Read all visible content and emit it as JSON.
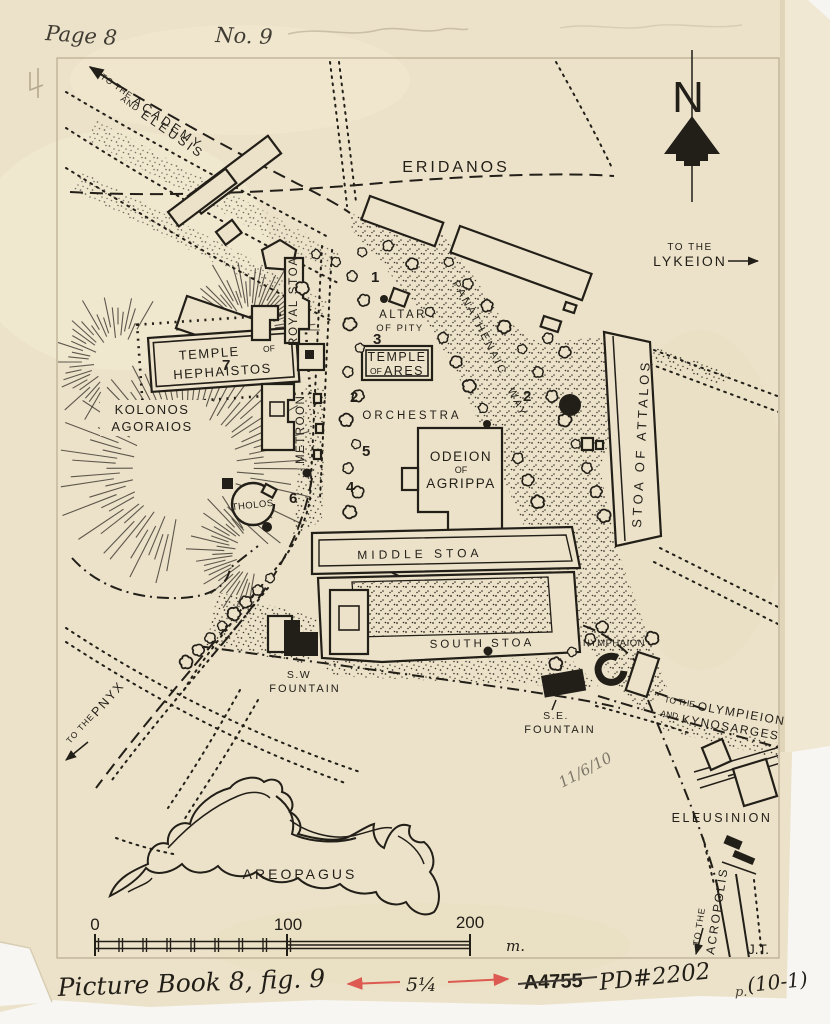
{
  "colors": {
    "ink": "#221e18",
    "paper": "#ece2c9",
    "pencil": "#998b72",
    "red": "#dd5a52",
    "blue": "#5560aa",
    "faded_red": "#e0767d"
  },
  "handwriting": {
    "page": "Page 8",
    "no9": "No. 9",
    "caption": "Picture Book 8, fig. 9",
    "measure": "5¼",
    "catalog": "A4755",
    "pd": "PD#2202",
    "p_small": "p.",
    "paren": "(10-1)",
    "date_faint": "11/6/10",
    "initials": "J.T."
  },
  "compass": {
    "n": "N"
  },
  "scalebar": {
    "t0": "0",
    "t100": "100",
    "t200": "200",
    "unit": "m."
  },
  "directions": {
    "academy_small": "TO THE",
    "academy": "ACADEMY",
    "and_small": "AND",
    "eleusis": "ELEUSIS",
    "lykeion_small": "TO THE",
    "lykeion": "LYKEION",
    "pnyx_small": "TO THE",
    "pnyx": "PNYX",
    "oly_small": "TO THE",
    "olympieion": "OLYMPIEION",
    "and2_small": "AND",
    "kynosarges": "KYNOSARGES",
    "acr_small": "TO THE",
    "acropolis": "ACROPOLIS"
  },
  "features": {
    "eridanos": "ERIDANOS",
    "kolonos1": "KOLONOS",
    "kolonos2": "AGORAIOS",
    "heph1": "TEMPLE",
    "heph_of": "OF",
    "heph2": "HEPHAISTOS",
    "royal_stoa": "ROYAL STOA",
    "metroon": "METROON",
    "tholos": "THOLOS",
    "altar1": "ALTAR",
    "altar2": "OF PITY",
    "ares1": "TEMPLE",
    "ares_of": "OF",
    "ares2": "ARES",
    "orchestra": "ORCHESTRA",
    "odeion1": "ODEION",
    "odeion2": "OF",
    "odeion3": "AGRIPPA",
    "middle_stoa": "MIDDLE STOA",
    "south_stoa": "SOUTH STOA",
    "stoa_attalos": "STOA OF ATTALOS",
    "panathenaic_way": "PANATHENAIC WAY",
    "nymphaion": "NYMPHAION",
    "sw1": "S.W",
    "sw2": "FOUNTAIN",
    "se1": "S.E.",
    "se2": "FOUNTAIN",
    "eleusinion": "ELEUSINION",
    "areopagus": "AREOPAGUS"
  },
  "numbers": {
    "n1": "1",
    "n2": "2",
    "n2b": "2",
    "n3": "3",
    "n4": "4",
    "n5": "5",
    "n6": "6",
    "n7": "7"
  }
}
